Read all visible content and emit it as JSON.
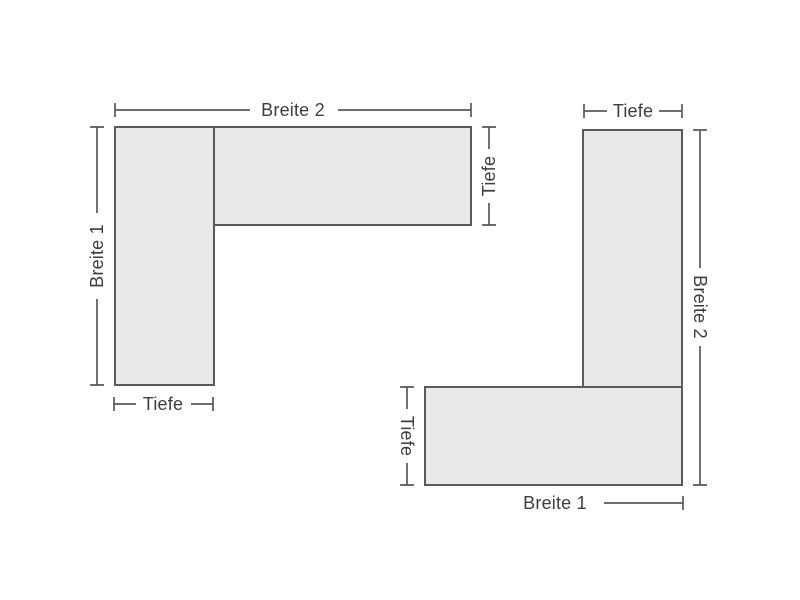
{
  "colors": {
    "background": "#ffffff",
    "shape_fill": "#e9e9e9",
    "line": "#5a5a5b",
    "text": "#3d3d3d"
  },
  "diagrams": {
    "left": {
      "description": "L-shaped corner unit, left-hand variant, dimension drawing",
      "labels": {
        "top": "Breite 2",
        "left": "Breite 1",
        "right": "Tiefe",
        "bottom": "Tiefe"
      }
    },
    "right": {
      "description": "L-shaped corner unit, right-hand variant, dimension drawing",
      "labels": {
        "top": "Tiefe",
        "right": "Breite 2",
        "left": "Tiefe",
        "bottom": "Breite 1"
      }
    }
  }
}
